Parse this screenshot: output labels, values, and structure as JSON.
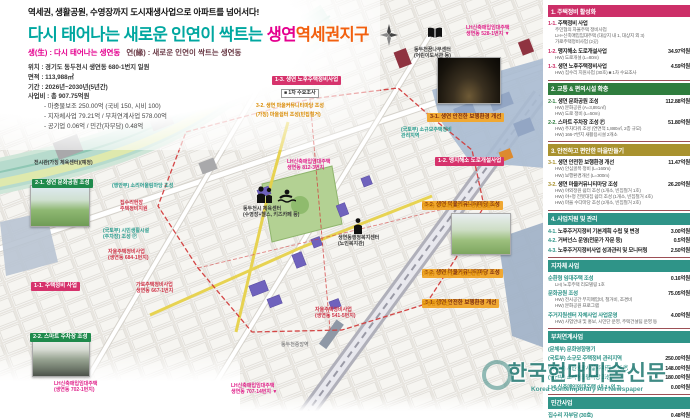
{
  "header": {
    "slogan": "역세권, 생활공원, 수영장까지 도시재생사업으로 아파트를 넘어서다!",
    "title_teal": "다시 태어나는 새로운 인연이 싹트는 ",
    "title_pink": "생연",
    "title_orange": "역세권지구",
    "subtitle_pink": "생(生) : 다시 태어나는 생연동",
    "subtitle_dark": "연(緣) : 새로운 인연이 싹트는 생연동",
    "info": [
      "위치 : 경기도 동두천시 생연동 680-1번지 일원",
      "면적 : 113,988㎡",
      "기간 : 2026년~2030년(5년간)",
      "사업비 : 총 907.75억원",
      "- 마중물보조 250.00억 (국비 150, 시비 100)",
      "- 지자체사업 79.21억 / 부처연계사업 578.00억",
      "- 공기업 0.06억 / 민간(자부담) 0.48억"
    ]
  },
  "panel": {
    "sections": [
      {
        "title": "1. 주택정비 활성화",
        "items": [
          {
            "no": "1-1.",
            "title": "주택정비 사업",
            "amount": "",
            "subs": [
              "주민협의 자율주택 정비사업",
              "LH+신축매입임대주택 (대상지 내 1, 대상지 외 3)",
              "가로주택정비사업 (2곳)"
            ]
          },
          {
            "no": "1-2.",
            "title": "맹지해소 도로개설사업",
            "amount": "34.97억원",
            "subs": [
              "HW) 도로개설 (L=80m)"
            ]
          },
          {
            "no": "1-3.",
            "title": "생연 노후주택정비사업",
            "amount": "4.59억원",
            "subs": [
              "HW) 집수리 지원사업 (30호)  ■ 1차 수요조사"
            ]
          }
        ]
      },
      {
        "title": "2. 교통 & 편의시설 확충",
        "items": [
          {
            "no": "2-1.",
            "title": "생연 문화공원 조성",
            "amount": "112.88억원",
            "subs": [
              "HW) 문화공원 (A=3,891㎡)",
              "HW) 도로 정비 (L=50m)"
            ]
          },
          {
            "no": "2-2.",
            "title": "스마트 주차장 조성 Ⓟ",
            "amount": "51.80억원",
            "subs": [
              "HW) 주차타워 조성 (연면적 1,880㎡, 2층 규모)",
              "HW) 166-7번지 새활용시설 2개소"
            ]
          }
        ]
      },
      {
        "title": "3. 안전하고 편안한 마을만들기",
        "items": [
          {
            "no": "3-1.",
            "title": "생연 안전한 보행환경 개선",
            "amount": "11.47억원",
            "subs": [
              "HW) 안심골목 정비 (L=160m)",
              "HW) 보행환경개선 (L=300m)"
            ]
          },
          {
            "no": "3-2.",
            "title": "생연 마을커뮤니티마당 조성",
            "amount": "26.20억원",
            "subs": [
              "HW) 야외정원 쉼터 조성 (1개소, 빈집철거 1호)",
              "HW) 야+정 전봇대집 쉼터 조성 (1개소, 빈집철거 4호)",
              "HW) 마을 수다마당 조성 (2개소, 빈집철거 2호)"
            ]
          }
        ]
      },
      {
        "title": "4. 사업지원 및 관리",
        "items": [
          {
            "no": "4-1.",
            "title": "노후주거지정비 기본계획 수립 및 변경",
            "amount": "3.00억원",
            "subs": []
          },
          {
            "no": "4-2.",
            "title": "거버넌스 운영(전문가 자문 등)",
            "amount": "0.5억원",
            "subs": []
          },
          {
            "no": "4-3.",
            "title": "노후주거지정비사업 성과관리 및 모니터링",
            "amount": "2.50억원",
            "subs": []
          }
        ]
      },
      {
        "title": "지자체 사업",
        "items": [
          {
            "no": "",
            "title": "순환형 임대주택 조성",
            "amount": "0.16억원",
            "subs": [
              "LH) 노후주택 리모델링 1호"
            ]
          },
          {
            "no": "",
            "title": "문화공원 조성",
            "amount": "75.05억원",
            "subs": [
              "HW) 전시공간 부지매입비, 철거비, 조경비",
              "HW) 문화공원 프로그램"
            ]
          },
          {
            "no": "",
            "title": "주거지원센터 자체사업 사업운영",
            "amount": "4.00억원",
            "subs": [
              "HW) 사업안내 및 홍보, 시민단 운영, 주택건설팀 운영 등"
            ]
          }
        ]
      },
      {
        "title": "부처연계사업",
        "items": [
          {
            "no": "",
            "title": "(문체부) 문화영향평가",
            "amount": "",
            "subs": []
          },
          {
            "no": "",
            "title": "(국토부) 소규모 주택정비 관리지역",
            "amount": "250.00억원",
            "subs": []
          },
          {
            "no": "",
            "title": "(국토부) 시민생활시설 주차장 조성 Ⓟ",
            "amount": "148.00억원",
            "subs": []
          },
          {
            "no": "",
            "title": "(행안부) 소리어울림마당 조성",
            "amount": "180.00억원",
            "subs": []
          },
          {
            "no": "",
            "title": "LH) 신축매입임대주택 (내 1+외 3)",
            "amount": "0.00억원",
            "subs": []
          }
        ]
      },
      {
        "title": "민간사업",
        "items": [
          {
            "no": "",
            "title": "집수리 자부담 (30호)",
            "amount": "0.48억원",
            "subs": []
          }
        ]
      }
    ]
  },
  "map": {
    "labels": [
      {
        "text": "1-3. 생연 노후주택정비사업"
      },
      {
        "text": "■ 1차 수요조사"
      },
      {
        "text": "3-2. 생연 마을커뮤니티마당 조성"
      },
      {
        "text": "(가칭) 마을쉼터 조성(빈집철거)"
      },
      {
        "text": "동두천꿈나무센터\n(어린이도서관 등)"
      },
      {
        "text": "LH신축매입임대주택\n생연동 528-1번지 ▼"
      },
      {
        "text": "3-1. 생연 안전한 보행환경 개선"
      },
      {
        "text": "1-2. 맹지해소 도로개설사업"
      },
      {
        "text": "(국토부) 소규모주택정비\n관리지역"
      },
      {
        "text": "3-2. 생연 마을커뮤니티마당 조성"
      },
      {
        "text": "(야외) 전봇대집 쉼터 조성(빈집철거)"
      },
      {
        "text": "3-2. 생연 마을커뮤니티마당 조성"
      },
      {
        "text": "(마을) 수다마당 조성(빈집철거)"
      },
      {
        "text": "3-1. 생연 안전한 보행환경 개선"
      },
      {
        "text": "보행환경개선"
      },
      {
        "text": "전시관(가칭 체육센터)(예정)"
      },
      {
        "text": "2-1. 생연 문화공원 조성"
      },
      {
        "text": "(행안부) 소리어울림마당 조성"
      },
      {
        "text": "집수리현장\n주택정비지원"
      },
      {
        "text": "(국토부) 시민생활시설\n(주차장) 조성 Ⓟ"
      },
      {
        "text": "자율주택정비사업\n(생연동 684-1번지)"
      },
      {
        "text": "1-1. 주택정비 사업"
      },
      {
        "text": "가로주택정비사업\n생연동 667-1번지"
      },
      {
        "text": "2-2. 스마트 주차장 조성"
      },
      {
        "text": "자율주택정비사업\n(생연동 541-5번지)"
      },
      {
        "text": "LH신축매입임대주택\n생연동 707-14번지 ▼"
      },
      {
        "text": "LH신축매입임대주택\n생연동 812-3번지"
      },
      {
        "text": "동두천시 체육센터\n(수영장+헬스, 키즈카페 등)"
      },
      {
        "text": "생연동행정복지센터\n(노인복지관)"
      },
      {
        "text": "동두천중앙역"
      },
      {
        "text": "LH신축매입임대주택\n(생연동 702-1번지)"
      }
    ]
  },
  "watermark": {
    "main": "한국현대미술신문",
    "sub": "Korea Contemporary Art Newspaper"
  },
  "colors": {
    "accent_teal": "#00a7a0",
    "accent_pink": "#e5008f",
    "accent_orange": "#f2600f",
    "sec1": "#cc2f68",
    "sec2": "#2f7d3e",
    "sec3": "#a9922f",
    "sec4": "#2f9488",
    "boundary_red": "#d23c3c",
    "watermark_teal": "#16726b"
  }
}
